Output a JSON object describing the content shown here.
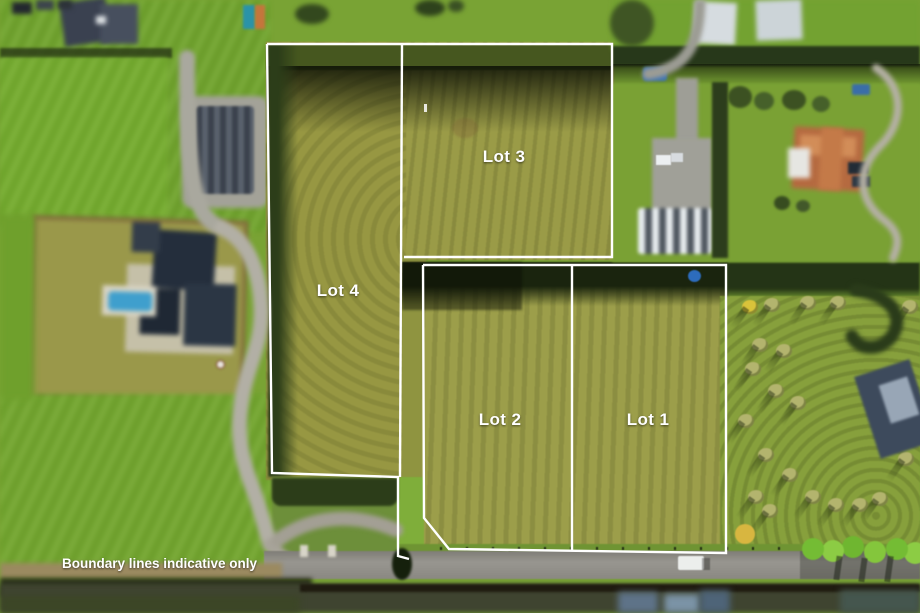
{
  "scene": {
    "type": "aerial-photo-with-lot-overlay",
    "disclaimer": "Boundary lines indicative only",
    "lots": [
      {
        "id": "lot-1",
        "label": "Lot 1",
        "label_x": 648,
        "label_y": 420
      },
      {
        "id": "lot-2",
        "label": "Lot 2",
        "label_x": 500,
        "label_y": 420
      },
      {
        "id": "lot-3",
        "label": "Lot 3",
        "label_x": 504,
        "label_y": 157
      },
      {
        "id": "lot-4",
        "label": "Lot 4",
        "label_x": 338,
        "label_y": 291
      }
    ],
    "colors": {
      "boundary_line": "#ffffff",
      "label_text": "#ffffff",
      "field_olive": "#9a9b47",
      "paddock_green": "#74a72f",
      "hedge_dark": "#2a3b1a",
      "road_grey": "#908e87"
    },
    "boundary_segments": [
      [
        [
          267,
          44
        ],
        [
          612,
          44
        ],
        [
          612,
          257
        ],
        [
          404,
          257
        ]
      ],
      [
        [
          267,
          44
        ],
        [
          272,
          473
        ],
        [
          398,
          477
        ],
        [
          398,
          556
        ],
        [
          409,
          559
        ]
      ],
      [
        [
          402,
          44
        ],
        [
          400,
          477
        ]
      ],
      [
        [
          423,
          265
        ],
        [
          726,
          265
        ],
        [
          726,
          553
        ],
        [
          449,
          549
        ],
        [
          424,
          518
        ],
        [
          423,
          265
        ]
      ],
      [
        [
          572,
          265
        ],
        [
          572,
          551
        ]
      ]
    ]
  }
}
